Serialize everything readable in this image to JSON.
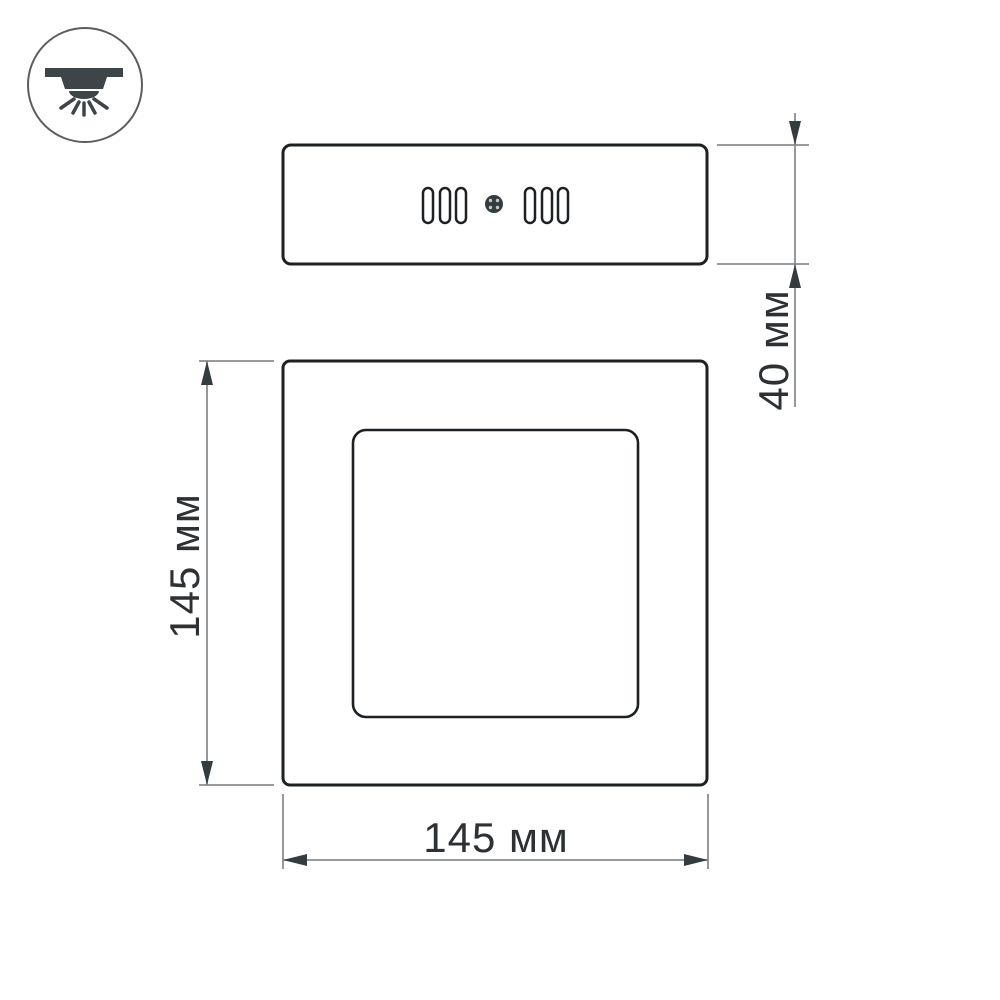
{
  "diagram": {
    "type": "product-dimension-drawing",
    "subject": "square surface-mounted LED panel light",
    "background": "#ffffff"
  },
  "icon_badge": {
    "name": "surface-mounted-downlight-icon",
    "description": "circled pictogram of a ceiling-mounted light shining downward"
  },
  "views": {
    "side_view": {
      "name": "side view (housing profile)",
      "vent_slots_left": 3,
      "vent_slots_right": 3,
      "screw_visible": true
    },
    "front_view": {
      "name": "front view (panel face with inner diffuser square)"
    }
  },
  "dimensions": {
    "depth": {
      "label": "40 мм"
    },
    "height": {
      "label": "145 мм"
    },
    "width": {
      "label": "145 мм"
    }
  },
  "colors": {
    "outline": "#1d2123",
    "dimension_line": "#8a8d8f",
    "arrowhead": "#343c40",
    "label_text": "#2e3133",
    "icon": "#3d4549"
  }
}
